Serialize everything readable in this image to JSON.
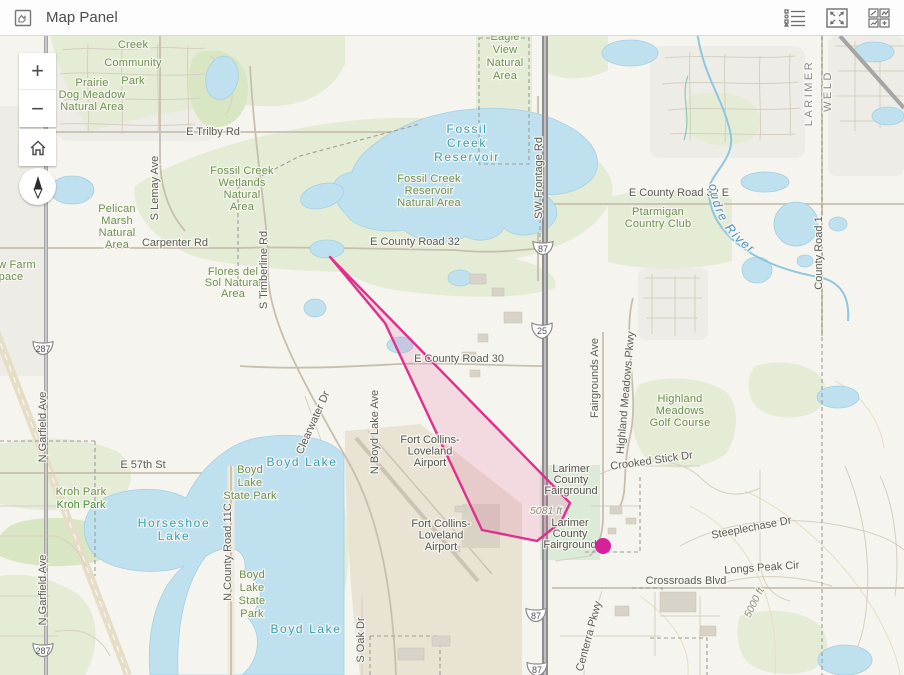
{
  "header": {
    "title": "Map Panel",
    "left_icon": "map-panel-icon",
    "actions": [
      {
        "id": "legend",
        "icon": "legend-list-icon"
      },
      {
        "id": "expand",
        "icon": "expand-arrows-icon"
      },
      {
        "id": "widgets",
        "icon": "widgets-grid-icon"
      }
    ]
  },
  "controls": {
    "zoom_in": "+",
    "zoom_out": "−",
    "home": "home-icon",
    "compass": "compass-north-icon"
  },
  "map": {
    "labels": [
      {
        "id": "creek-community-park",
        "cls": "park",
        "x": 133,
        "y": 12,
        "lh": 18,
        "size": 12,
        "ls": 1,
        "lines": [
          "Creek",
          "Community",
          "Park"
        ]
      },
      {
        "id": "prairie-dog-meadow-natural-area",
        "cls": "park",
        "x": 92,
        "y": 50,
        "lh": 12,
        "lines": [
          "Prairie",
          "Dog Meadow",
          "Natural Area"
        ]
      },
      {
        "id": "eagle-view-natural-area",
        "cls": "park",
        "x": 505,
        "y": 4,
        "lh": 13,
        "lines": [
          "Eagle",
          "View",
          "Natural",
          "Area"
        ]
      },
      {
        "id": "fossil-creek-wetlands-natural-area",
        "cls": "park",
        "x": 242,
        "y": 138,
        "lh": 12,
        "lines": [
          "Fossil Creek",
          "Wetlands",
          "Natural",
          "Area"
        ]
      },
      {
        "id": "fossil-creek-reservoir-natural-area",
        "cls": "park",
        "x": 429,
        "y": 146,
        "lh": 12,
        "lines": [
          "Fossil Creek",
          "Reservoir",
          "Natural Area"
        ]
      },
      {
        "id": "pelican-marsh-natural-area",
        "cls": "park",
        "x": 117,
        "y": 176,
        "lh": 12,
        "lines": [
          "Pelican",
          "Marsh",
          "Natural",
          "Area"
        ]
      },
      {
        "id": "flores-del-sol-natural-area",
        "cls": "park",
        "x": 233,
        "y": 239,
        "lh": 11,
        "lines": [
          "Flores del",
          "Sol Natural",
          "Area"
        ]
      },
      {
        "id": "ptarmigan-country-club",
        "cls": "park",
        "x": 658,
        "y": 179,
        "lh": 12,
        "lines": [
          "Ptarmigan",
          "Country Club"
        ]
      },
      {
        "id": "highland-meadows-golf-course",
        "cls": "park",
        "x": 680,
        "y": 366,
        "lh": 12,
        "lines": [
          "Highland",
          "Meadows",
          "Golf Course"
        ]
      },
      {
        "id": "kroh-park-1",
        "cls": "park",
        "x": 81,
        "y": 459,
        "lines": [
          "Kroh Park"
        ]
      },
      {
        "id": "kroh-park-2",
        "cls": "park2",
        "x": 81,
        "y": 472,
        "lines": [
          "Kroh Park"
        ]
      },
      {
        "id": "boyd-lake-state-park-n",
        "cls": "park",
        "x": 250,
        "y": 437,
        "lh": 13,
        "lines": [
          "Boyd",
          "Lake",
          "State Park"
        ]
      },
      {
        "id": "boyd-lake-state-park-s",
        "cls": "park",
        "x": 252,
        "y": 542,
        "lh": 13,
        "lines": [
          "Boyd",
          "Lake",
          "State",
          "Park"
        ]
      },
      {
        "id": "farm-open-space-clipped-1",
        "cls": "park",
        "x": 17,
        "y": 232,
        "lines": [
          "w Farm"
        ]
      },
      {
        "id": "farm-open-space-clipped-2",
        "cls": "park",
        "x": 11,
        "y": 244,
        "lines": [
          "pace"
        ]
      },
      {
        "id": "fort-collins-loveland-airport-n",
        "cls": "site",
        "x": 430,
        "y": 407,
        "lh": 11.5,
        "lines": [
          "Fort Collins-",
          "Loveland",
          "Airport"
        ]
      },
      {
        "id": "fort-collins-loveland-airport-s",
        "cls": "site",
        "x": 441,
        "y": 491,
        "lh": 11.5,
        "lines": [
          "Fort Collins-",
          "Loveland",
          "Airport"
        ]
      },
      {
        "id": "larimer-county-fairground-n",
        "cls": "site",
        "x": 571,
        "y": 436,
        "lh": 11,
        "lines": [
          "Larimer",
          "County",
          "Fairground"
        ]
      },
      {
        "id": "larimer-county-fairground-s",
        "cls": "site",
        "x": 570,
        "y": 490,
        "lh": 11,
        "lines": [
          "Larimer",
          "County",
          "Fairground"
        ]
      },
      {
        "id": "e-trilby-rd",
        "cls": "road",
        "x": 213,
        "y": 99,
        "lines": [
          "E Trilby Rd"
        ]
      },
      {
        "id": "carpenter-rd",
        "cls": "road",
        "x": 175,
        "y": 210,
        "lines": [
          "Carpenter Rd"
        ]
      },
      {
        "id": "e-county-road-32",
        "cls": "road",
        "x": 415,
        "y": 209,
        "lines": [
          "E County Road 32"
        ]
      },
      {
        "id": "e-county-road-32-e",
        "cls": "road",
        "x": 679,
        "y": 160,
        "lines": [
          "E County Road 32 E"
        ]
      },
      {
        "id": "e-county-road-30",
        "cls": "road",
        "x": 459,
        "y": 326,
        "lines": [
          "E County Road 30"
        ]
      },
      {
        "id": "e-57th-st",
        "cls": "road",
        "x": 143,
        "y": 432,
        "lines": [
          "E 57th St"
        ]
      },
      {
        "id": "crossroads-blvd",
        "cls": "road",
        "x": 686,
        "y": 548,
        "lines": [
          "Crossroads Blvd"
        ]
      },
      {
        "id": "longs-peak-cir",
        "cls": "road",
        "x": 762,
        "y": 535,
        "rot": -4,
        "lines": [
          "Longs Peak Cir"
        ]
      },
      {
        "id": "steeplechase-dr",
        "cls": "road",
        "x": 752,
        "y": 495,
        "rot": -11,
        "lines": [
          "Steeplechase Dr"
        ]
      },
      {
        "id": "crooked-stick-dr",
        "cls": "road",
        "x": 652,
        "y": 428,
        "rot": -8,
        "lines": [
          "Crooked Stick Dr"
        ]
      },
      {
        "id": "s-lemay-ave",
        "cls": "road",
        "x": 158,
        "y": 152,
        "rot": -90,
        "lines": [
          "S Lemay Ave"
        ]
      },
      {
        "id": "s-timberline-rd",
        "cls": "road",
        "x": 267,
        "y": 234,
        "rot": -90,
        "lines": [
          "S Timberline Rd"
        ]
      },
      {
        "id": "n-garfield-ave-n",
        "cls": "road",
        "x": 46,
        "y": 391,
        "rot": -90,
        "lines": [
          "N Garfield Ave"
        ]
      },
      {
        "id": "n-garfield-ave-s",
        "cls": "road",
        "x": 46,
        "y": 554,
        "rot": -90,
        "lines": [
          "N Garfield Ave"
        ]
      },
      {
        "id": "n-county-road-11c",
        "cls": "road",
        "x": 231,
        "y": 516,
        "rot": -90,
        "lines": [
          "N County Road 11C"
        ]
      },
      {
        "id": "n-boyd-lake-ave",
        "cls": "road",
        "x": 378,
        "y": 396,
        "rot": -90,
        "lines": [
          "N Boyd Lake Ave"
        ]
      },
      {
        "id": "sw-frontage-rd",
        "cls": "road",
        "x": 542,
        "y": 142,
        "rot": -90,
        "lines": [
          "SW Frontage Rd"
        ]
      },
      {
        "id": "fairgrounds-ave",
        "cls": "road",
        "x": 598,
        "y": 342,
        "rot": -90,
        "lines": [
          "Fairgrounds Ave"
        ]
      },
      {
        "id": "highland-meadows-pkwy",
        "cls": "road",
        "x": 629,
        "y": 357,
        "rot": -85,
        "lines": [
          "Highland Meadows Pkwy"
        ]
      },
      {
        "id": "county-road-1",
        "cls": "road",
        "x": 822,
        "y": 217,
        "rot": -90,
        "lines": [
          "County Road 1"
        ]
      },
      {
        "id": "s-oak-dr",
        "cls": "road",
        "x": 364,
        "y": 604,
        "rot": -90,
        "lines": [
          "S Oak Dr"
        ]
      },
      {
        "id": "clearwater-dr",
        "cls": "road",
        "x": 316,
        "y": 388,
        "rot": -66,
        "lines": [
          "Clearwater Dr"
        ]
      },
      {
        "id": "centerra-pkwy",
        "cls": "road",
        "x": 592,
        "y": 601,
        "rot": -75,
        "lines": [
          "Centerra Pkwy"
        ]
      },
      {
        "id": "larimer-county",
        "cls": "county",
        "x": 812,
        "y": 57,
        "rot": -90,
        "lines": [
          "LARIMER"
        ]
      },
      {
        "id": "weld-county",
        "cls": "county",
        "x": 831,
        "y": 55,
        "rot": -90,
        "lines": [
          "WELD"
        ]
      },
      {
        "id": "fossil-creek-reservoir",
        "cls": "water",
        "x": 467,
        "y": 97,
        "lh": 14,
        "size": 12.5,
        "lines": [
          "Fossil",
          "Creek",
          "Reservoir"
        ]
      },
      {
        "id": "boyd-lake-n",
        "cls": "water",
        "x": 302,
        "y": 430,
        "lines": [
          "Boyd Lake"
        ]
      },
      {
        "id": "boyd-lake-s",
        "cls": "water",
        "x": 306,
        "y": 597,
        "lines": [
          "Boyd Lake"
        ]
      },
      {
        "id": "horseshoe-lake",
        "cls": "water",
        "x": 174,
        "y": 491,
        "lh": 13,
        "lines": [
          "Horseshoe",
          "Lake"
        ]
      },
      {
        "id": "cache-la-poudre-river",
        "cls": "river",
        "path": "river-label-path",
        "lines": [
          "Cache la Poudre River"
        ]
      },
      {
        "id": "elevation-5081-ft",
        "cls": "elev",
        "x": 546,
        "y": 478,
        "lines": [
          "5081 ft"
        ]
      },
      {
        "id": "elevation-5000-ft",
        "cls": "elev",
        "x": 757,
        "y": 568,
        "rot": -64,
        "lines": [
          "5000 ft"
        ]
      }
    ],
    "shields": [
      {
        "id": "us-287-north",
        "type": "us",
        "text": "287",
        "x": 43,
        "y": 312
      },
      {
        "id": "us-287-south",
        "type": "us",
        "text": "287",
        "x": 43,
        "y": 614
      },
      {
        "id": "us-87-north",
        "type": "us",
        "text": "87",
        "x": 543,
        "y": 212
      },
      {
        "id": "us-87-south",
        "type": "us",
        "text": "87",
        "x": 536,
        "y": 579
      },
      {
        "id": "us-87-edge",
        "type": "us",
        "text": "87",
        "x": 537,
        "y": 633
      },
      {
        "id": "i-25",
        "type": "interstate",
        "text": "25",
        "x": 542,
        "y": 294
      }
    ],
    "overlay": {
      "polygon": {
        "points": "330,221 570,467 561,486 537,505 482,494 385,287",
        "stroke": "#e0308c",
        "fill": "#e0308c",
        "fill_opacity": 0.13
      },
      "marker": {
        "x": 603,
        "y": 510,
        "r": 8,
        "color": "#d6219b"
      }
    }
  }
}
